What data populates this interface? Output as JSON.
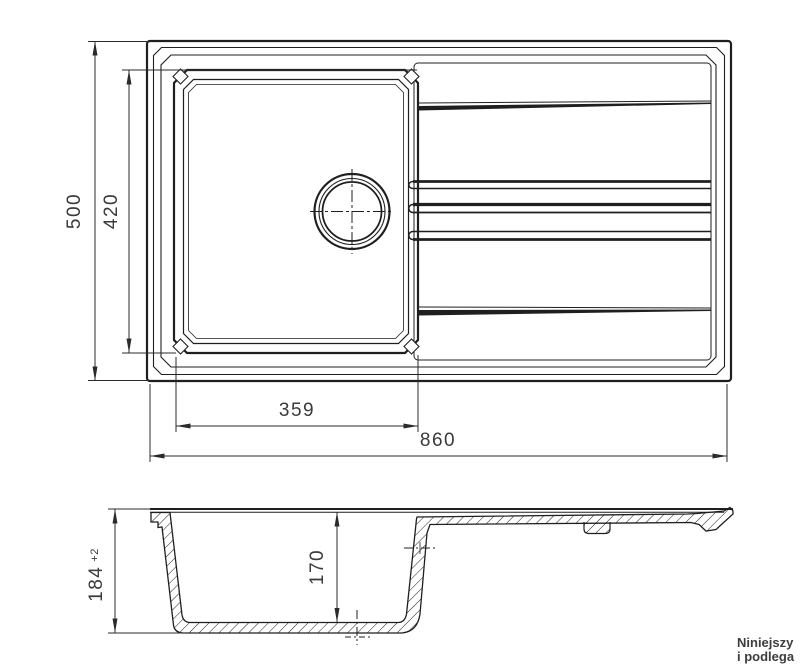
{
  "colors": {
    "line": "#1f1f1f",
    "dimension": "#2b2b2b",
    "text": "#3a3a3a",
    "watermark": "#3d3d3d",
    "background": "#ffffff"
  },
  "dims": {
    "total_depth": "500",
    "bowl_depth_inner": "420",
    "bowl_width_inner": "359",
    "total_width": "860",
    "height": "184",
    "height_tol": "+2",
    "bowl_depth_section": "170"
  },
  "watermark": {
    "line1": "Niniejszy",
    "line2": "i podlega"
  }
}
